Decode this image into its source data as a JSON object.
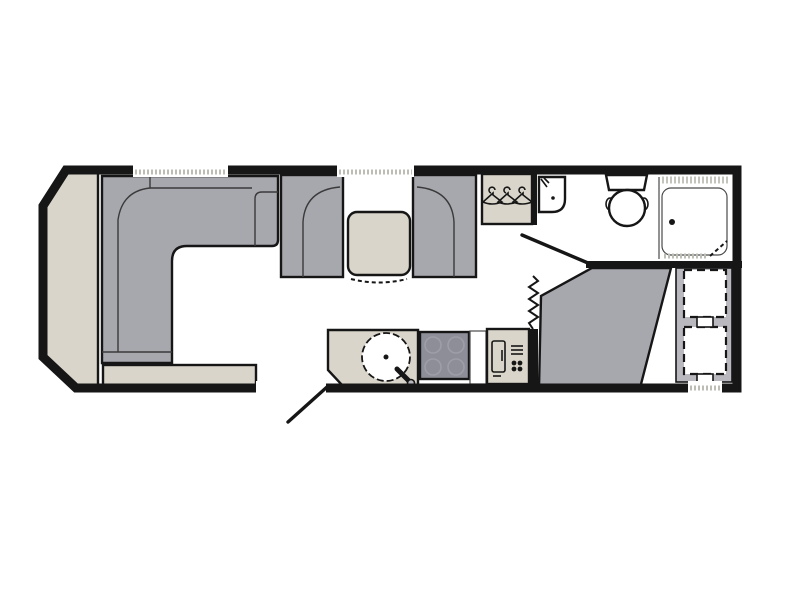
{
  "diagram": {
    "type": "caravan-floor-plan",
    "orientation": "front-left-rear-right",
    "areas": [
      "front lounge",
      "dinette",
      "kitchen",
      "washroom",
      "rear bedroom"
    ],
    "features": [
      "front chest shelf",
      "L-shaped lounge sofa",
      "low bench seat",
      "dinette seat left",
      "dinette table",
      "dinette seat right",
      "wardrobe with hangers",
      "washbasin",
      "toilet",
      "shower cubicle",
      "bathroom door swing",
      "entrance door swing",
      "concertina partition",
      "kitchen counter",
      "round sink with tap",
      "cooktop",
      "refrigerator",
      "corner bed",
      "upper bunk",
      "lower bunk",
      "windows",
      "entrance doorway"
    ]
  },
  "colors": {
    "background": "#ffffff",
    "wall": "#161616",
    "upholstery": "#a7a7ae",
    "surface": "#d9d5ca",
    "worktop": "#e4e1d8",
    "cooktop": "#8e8e98",
    "platform": "#b8b8be",
    "fixture": "#ffffff",
    "hatch": "#bdbdb6"
  }
}
